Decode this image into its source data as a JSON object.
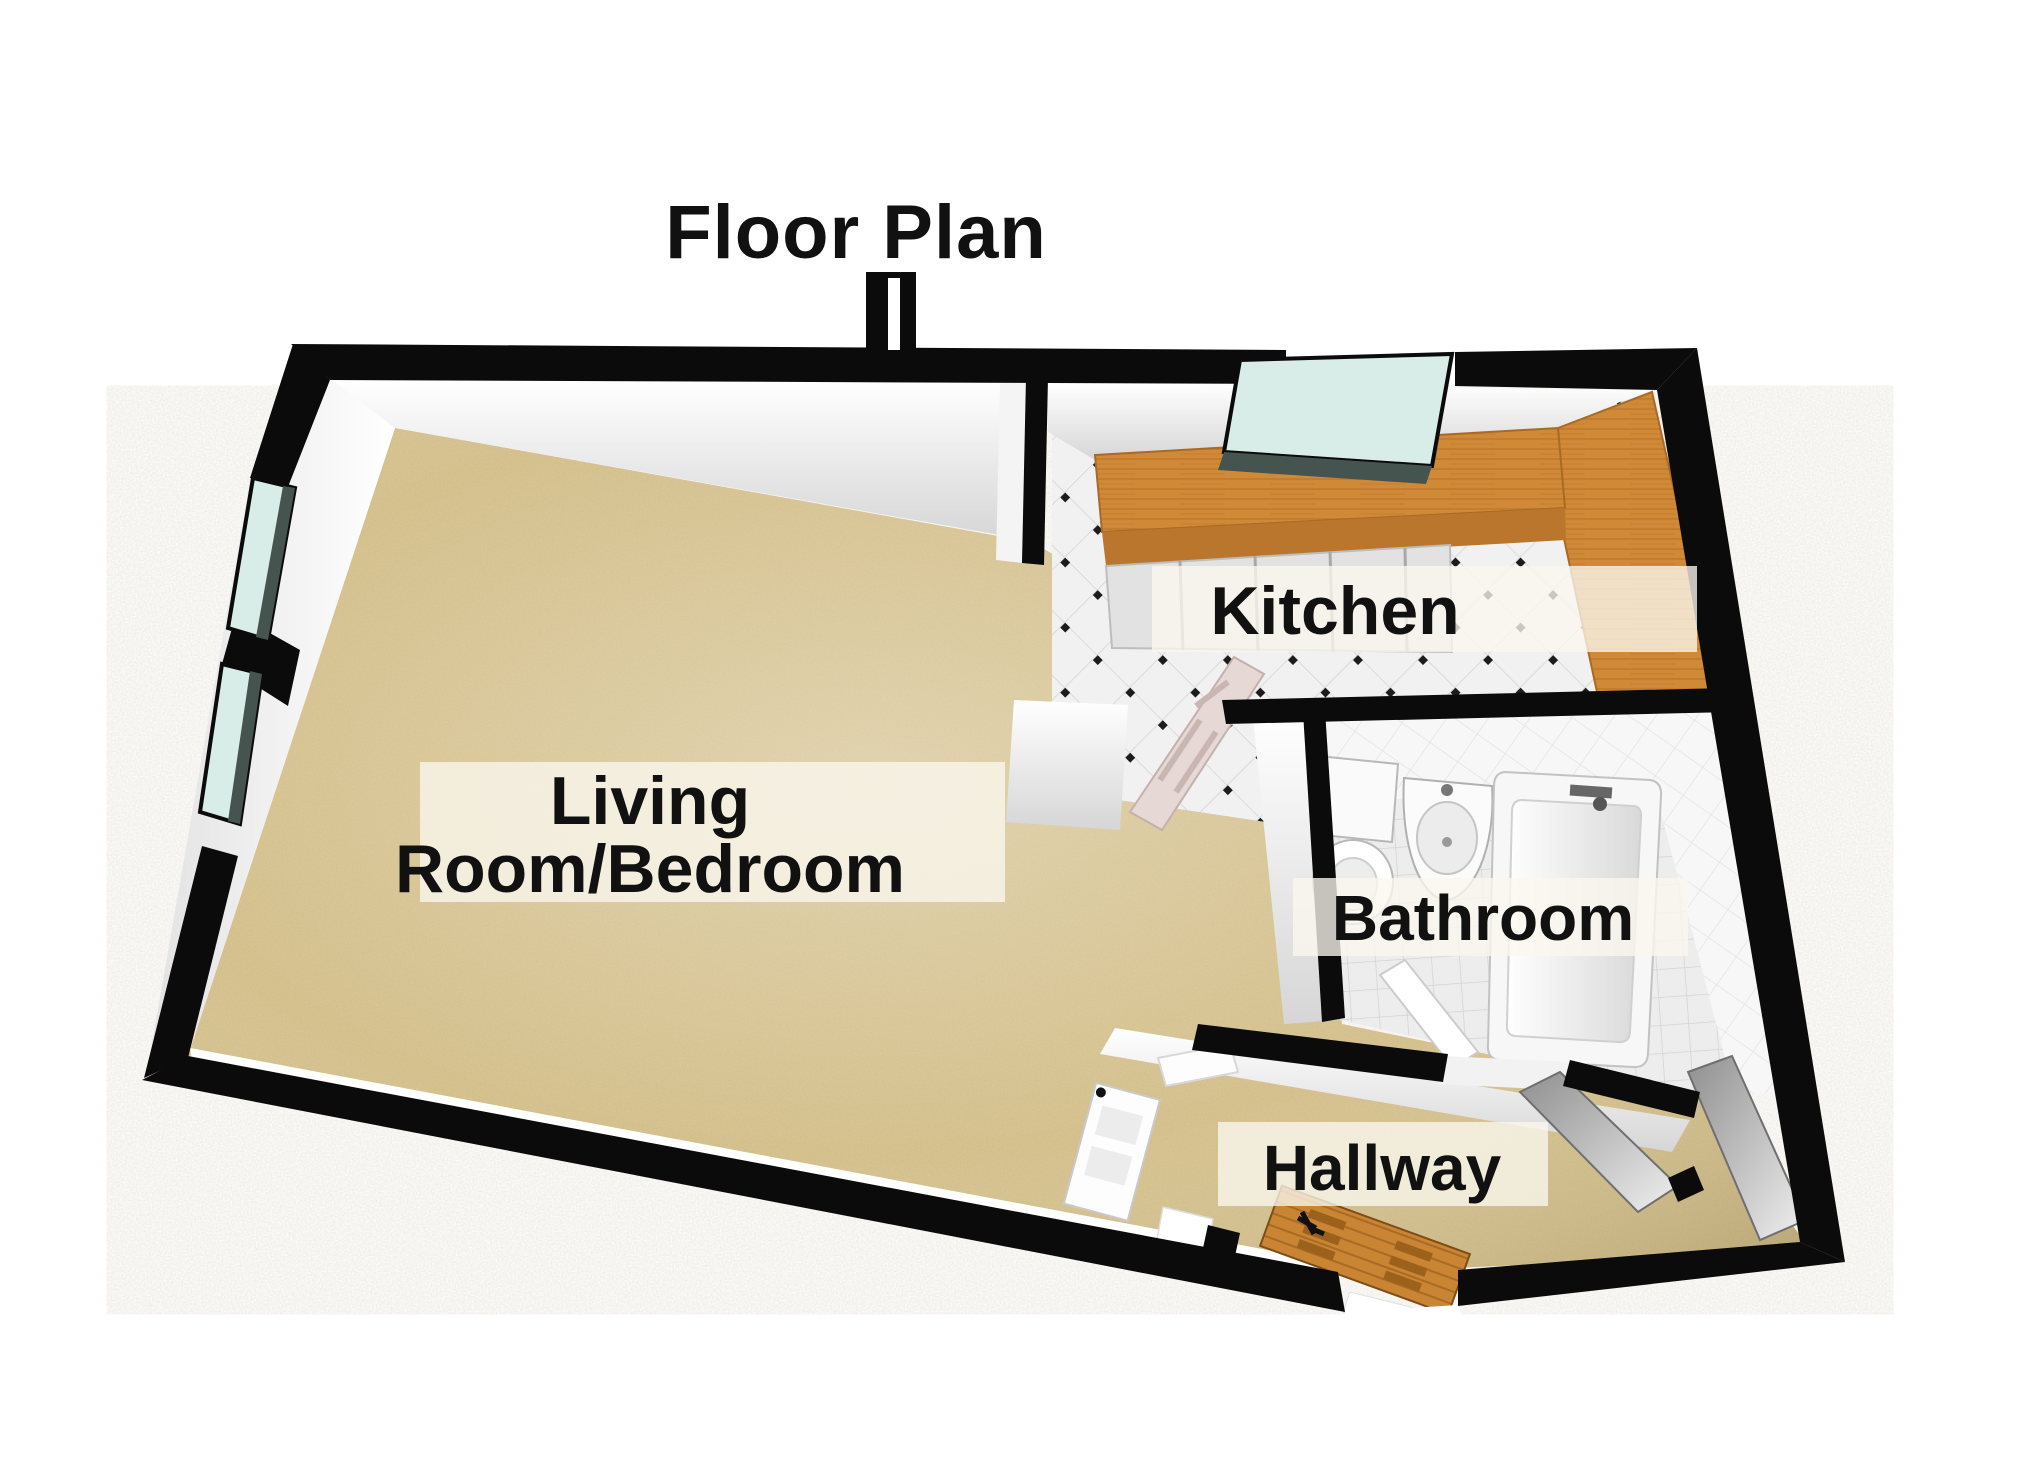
{
  "title": "Floor Plan",
  "rooms": {
    "living": {
      "label_line1": "Living",
      "label_line2": "Room/Bedroom"
    },
    "kitchen": {
      "label": "Kitchen"
    },
    "bathroom": {
      "label": "Bathroom"
    },
    "hallway": {
      "label": "Hallway"
    }
  },
  "fixtures": {
    "toilet": "toilet",
    "sink": "wall sink",
    "bathtub": "bathtub",
    "counter": "kitchen counter",
    "entrance_door": "wooden entrance door"
  },
  "colors": {
    "wall": "#0b0b0b",
    "carpet": "#d9c591",
    "counter_wood": "#d08937",
    "counter_wood_dark": "#b9762c",
    "door_wood": "#c98434",
    "window_glass": "#d8ece8",
    "glass_edge": "#46544f",
    "label_text": "#111111",
    "inner_face_light": "#ffffff",
    "inner_face_dark": "#d6d6d6"
  }
}
